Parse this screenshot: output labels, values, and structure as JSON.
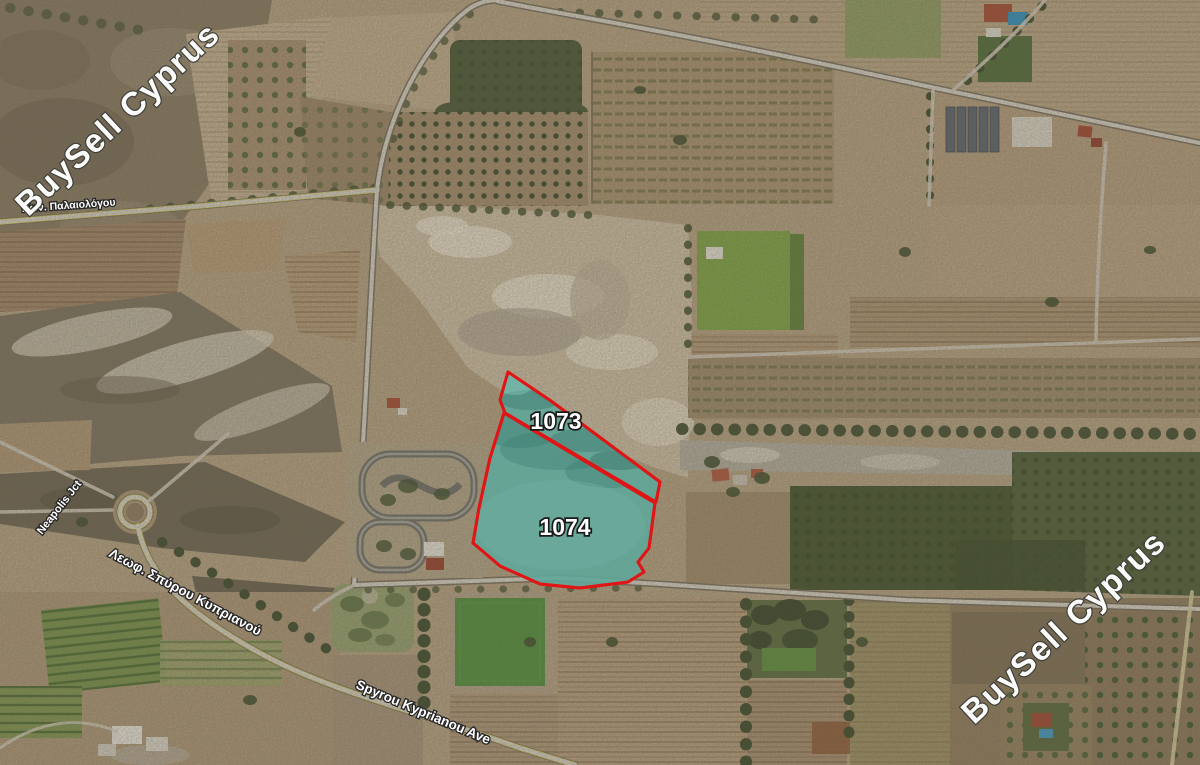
{
  "map": {
    "watermark": {
      "text": "BuySell Cyprus"
    },
    "plots": [
      {
        "id": "1073"
      },
      {
        "id": "1074"
      }
    ],
    "streets": {
      "palaiologou": "Κων. Παλαιολόγου",
      "neapolis_jct": "Neapolis Jct",
      "leoforos": "Λεωφ. Σπύρου Κυπριανού",
      "spyrou_ave": "Spyrou Kyprianou Ave"
    },
    "colors": {
      "plot_outline": "#e01515",
      "plot_fill": "#5ea79b",
      "street_label_fill": "#ffffff",
      "street_label_outline": "#262626",
      "watermark_fill": "#fbfbf9",
      "watermark_outline": "#3e3e3a"
    }
  }
}
